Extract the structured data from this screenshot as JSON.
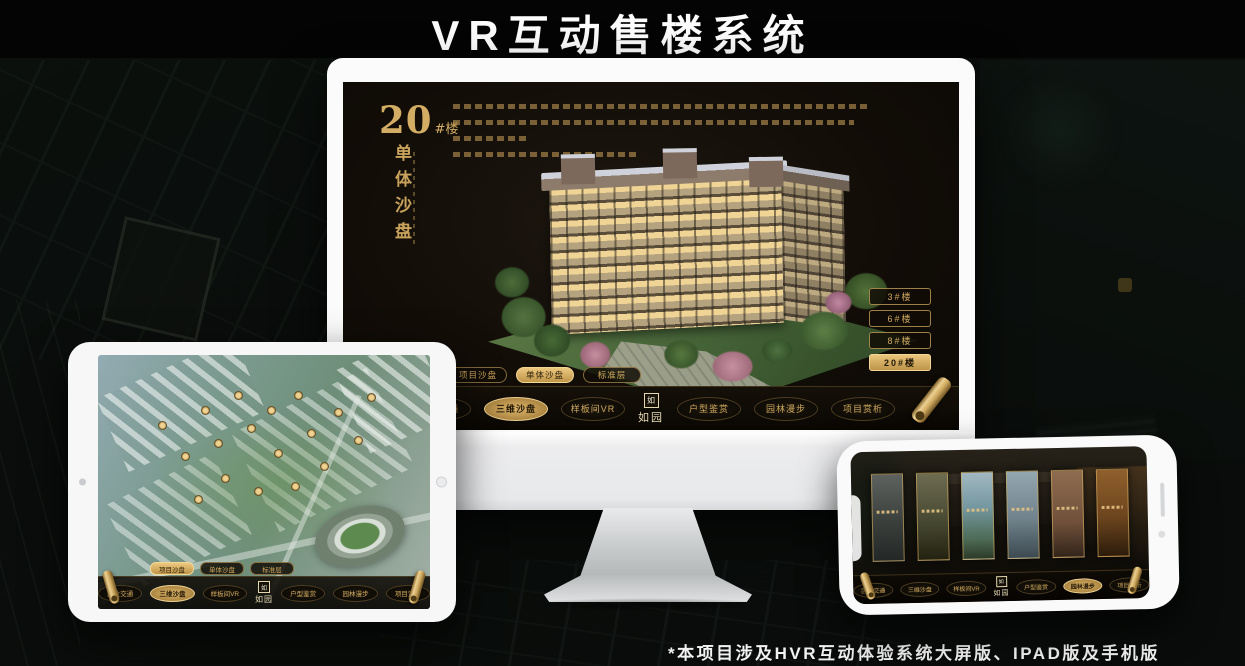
{
  "title": "VR互动售楼系统",
  "footnote": "*本项目涉及HVR互动体验系统大屏版、IPAD版及手机版",
  "nav": {
    "logo_seal": "如",
    "logo_text": "如园",
    "items": [
      "区位交通",
      "三维沙盘",
      "样板间VR",
      "户型鉴赏",
      "园林漫步",
      "项目赏析"
    ]
  },
  "sub_tabs": [
    "项目沙盘",
    "单体沙盘",
    "标准层"
  ],
  "monitor": {
    "building_no": "20",
    "building_no_suffix": "#楼",
    "vertical_title": "单体沙盘",
    "building_buttons": [
      "3#楼",
      "6#楼",
      "8#楼",
      "20#楼"
    ],
    "selected_building": "20#楼",
    "active_sub_tab": "单体沙盘",
    "active_nav": "三维沙盘"
  },
  "tablet": {
    "active_sub_tab": "项目沙盘",
    "active_nav": "三维沙盘"
  },
  "phone": {
    "active_nav": "园林漫步",
    "gallery_panel_count": 6
  },
  "colors": {
    "gold": "#cfa95f",
    "gold_bright": "#e7c27a",
    "screen_bg": "#16100a",
    "canvas_bg": "#0a0e0c",
    "title_text": "#fdfdfd"
  }
}
